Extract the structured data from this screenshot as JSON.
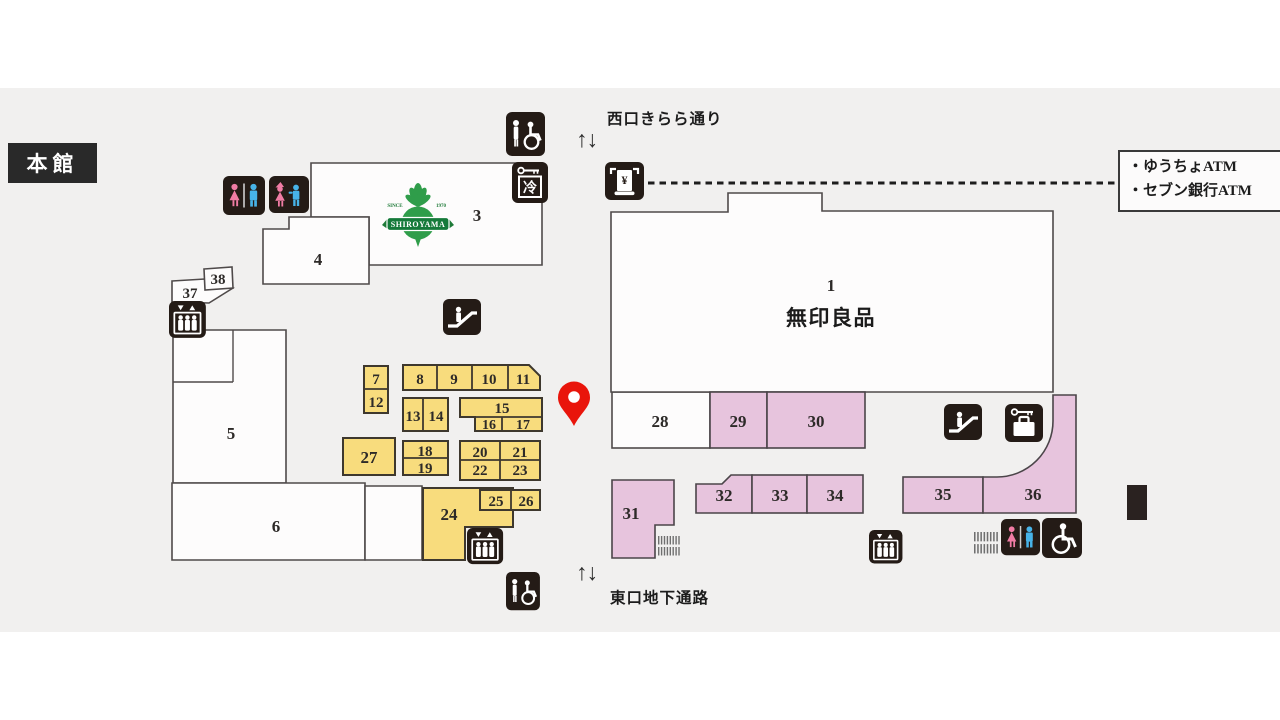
{
  "title": "本館",
  "streets": {
    "top": "西口きらら通り",
    "bottom": "東口地下通路"
  },
  "arrows": {
    "top": "↑↓",
    "bottom": "↑↓"
  },
  "atm_legend": {
    "line1": "・ゆうちょATM",
    "line2": "・セブン銀行ATM"
  },
  "tenants": {
    "u1_name": "無印良品"
  },
  "logo": {
    "name": "SHIROYAMA",
    "since": "SINCE",
    "year": "1970"
  },
  "glyphs": {
    "cold": "冷",
    "yen": "¥"
  },
  "unit_labels": {
    "u1": "1",
    "u3": "3",
    "u4": "4",
    "u5": "5",
    "u6": "6",
    "u7": "7",
    "u8": "8",
    "u9": "9",
    "u10": "10",
    "u11": "11",
    "u12": "12",
    "u13": "13",
    "u14": "14",
    "u15": "15",
    "u16": "16",
    "u17": "17",
    "u18": "18",
    "u19": "19",
    "u20": "20",
    "u21": "21",
    "u22": "22",
    "u23": "23",
    "u24": "24",
    "u25": "25",
    "u26": "26",
    "u27": "27",
    "u28": "28",
    "u29": "29",
    "u30": "30",
    "u31": "31",
    "u32": "32",
    "u33": "33",
    "u34": "34",
    "u35": "35",
    "u36": "36",
    "u37": "37",
    "u38": "38"
  },
  "icons": [
    "toilet-icon",
    "kids-toilet-icon",
    "accessible-toilet-icon",
    "wheelchair-icon",
    "elevator-icon",
    "escalator-icon",
    "coin-locker-cold-icon",
    "coin-locker-icon",
    "atm-icon",
    "stairs-icon",
    "map-pin-icon"
  ],
  "colors": {
    "unit_yellow": "#f8dc7d",
    "unit_pink": "#e7c4dd",
    "unit_white": "#fdfcfc",
    "icon_black": "#241b16",
    "pin_red": "#e9150b",
    "logo_green": "#2f9d4a",
    "background": "#f1f0ef"
  }
}
